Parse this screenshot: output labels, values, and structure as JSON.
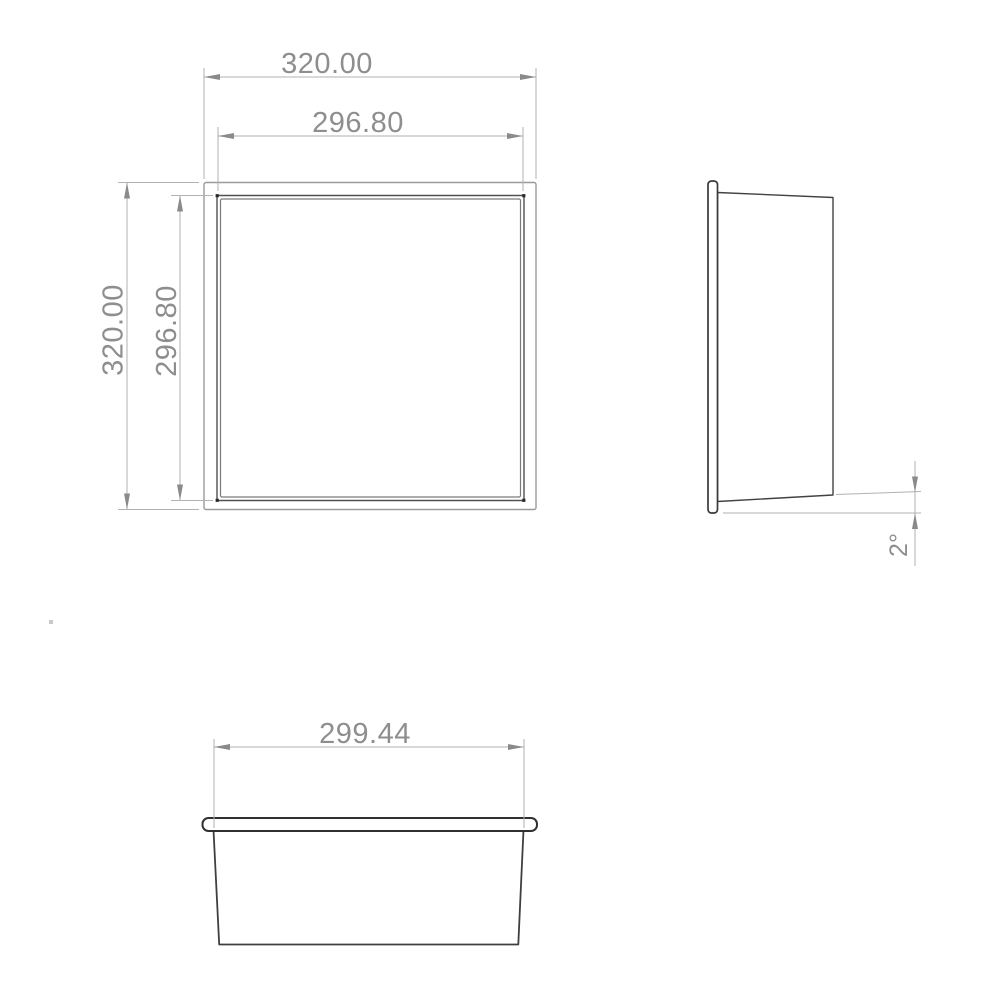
{
  "drawing": {
    "type": "engineering-drawing",
    "units": "mm",
    "colors": {
      "background": "#ffffff",
      "object_line": "#3f3f3f",
      "frame_line": "#515151",
      "dimension_line": "#b2b2b2",
      "dimension_text": "#8e8e8e"
    },
    "front_view": {
      "dim_outer_width": "320.00",
      "dim_inner_width": "296.80",
      "dim_outer_height": "320.00",
      "dim_inner_height": "296.80"
    },
    "side_view": {
      "dim_draft_angle": "2°"
    },
    "bottom_view": {
      "dim_opening_width": "299.44"
    }
  }
}
